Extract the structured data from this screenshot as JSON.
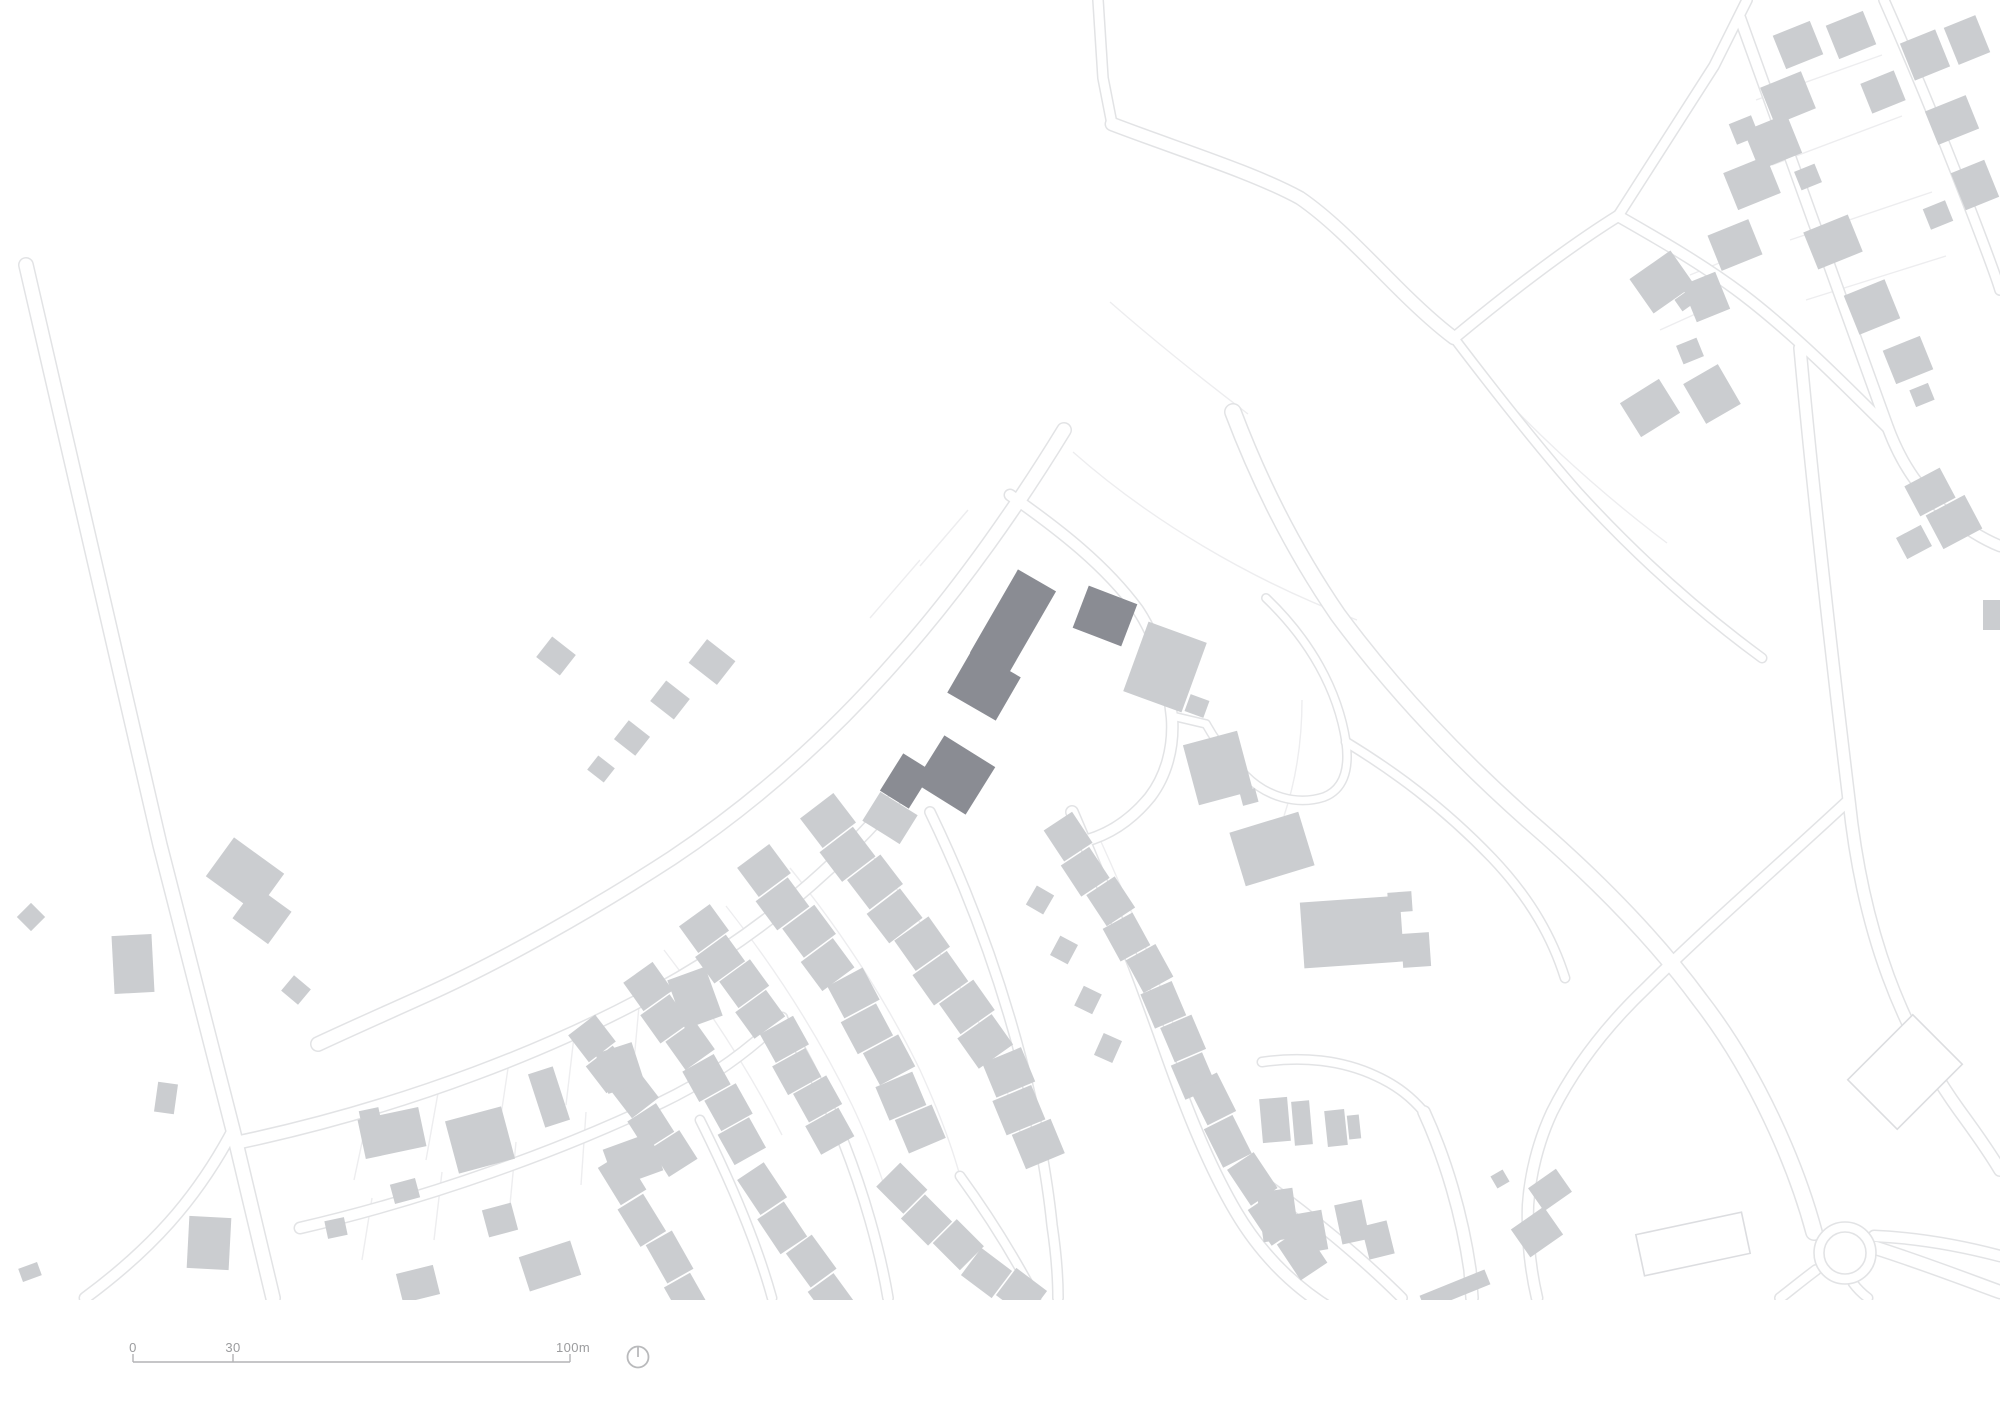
{
  "colors": {
    "background": "#ffffff",
    "building_light": "#cbcdd0",
    "building_site": "#8a8c93",
    "building_outline_stroke": "#dcdde0",
    "road_casing": "#e2e3e5",
    "parcel_line": "#ededef",
    "scalebar_line": "#b3b4b6",
    "scalebar_text": "#9b9c9e",
    "north_icon": "#b9babc"
  },
  "scalebar": {
    "x1": 133,
    "x2": 570,
    "y": 1362,
    "label_y": 1340,
    "tick_xs": [
      133,
      233,
      570
    ],
    "labels": [
      {
        "text": "0",
        "x": 133
      },
      {
        "text": "30",
        "x": 233
      },
      {
        "text": "100m",
        "x": 573
      }
    ]
  },
  "north_icon": {
    "cx": 638,
    "cy": 1357,
    "r": 10.5
  },
  "map": {
    "width": 2000,
    "height": 1414,
    "content_bottom": 1300,
    "roads": [
      {
        "d": "M 26 265 L 160 845 L 233 1130 L 273 1298",
        "w": 13
      },
      {
        "d": "M 233 1130 C 196 1200 150 1250 85 1298",
        "w": 10
      },
      {
        "d": "M 240 1142 C 400 1108 560 1048 680 978 C 762 930 834 870 894 800",
        "w": 12
      },
      {
        "d": "M 300 1228 C 430 1198 562 1150 662 1102 C 712 1078 752 1048 782 1018",
        "w": 10
      },
      {
        "d": "M 1098 0 L 1103 78 L 1112 124",
        "w": 9
      },
      {
        "d": "M 1112 124 C 1180 150 1252 172 1300 198 C 1332 220 1362 252 1396 286 C 1420 310 1438 326 1454 338",
        "w": 12
      },
      {
        "d": "M 1454 338 C 1492 388 1534 442 1578 492 C 1640 560 1702 614 1762 658",
        "w": 8
      },
      {
        "d": "M 1454 338 C 1512 290 1570 246 1618 216",
        "w": 10
      },
      {
        "d": "M 1618 216 L 1714 66 L 1747 0",
        "w": 9
      },
      {
        "d": "M 1740 18 C 1790 160 1840 296 1888 428 C 1903 468 1922 492 1945 512 C 1965 528 1985 540 2000 546",
        "w": 10
      },
      {
        "d": "M 1884 0 C 1915 70 1946 146 1973 216 C 1986 250 1996 276 2000 290",
        "w": 9
      },
      {
        "d": "M 1618 216 C 1660 240 1702 264 1742 294 C 1792 332 1842 382 1888 428",
        "w": 10
      },
      {
        "d": "M 1800 348 C 1812 480 1832 660 1849 800 C 1863 935 1903 1032 1959 1110 C 1981 1140 1994 1160 2000 1170",
        "w": 11
      },
      {
        "d": "M 1064 430 C 1020 502 962 586 898 658 C 830 736 756 802 672 858 C 592 910 500 962 424 996 C 384 1014 348 1030 318 1044",
        "w": 13
      },
      {
        "d": "M 1010 495 C 1060 530 1106 566 1138 610 C 1158 640 1168 680 1172 718 C 1174 748 1166 776 1150 797 C 1128 824 1102 838 1076 843",
        "w": 10
      },
      {
        "d": "M 1072 812 C 1108 896 1140 978 1166 1052 C 1188 1114 1210 1168 1236 1212 C 1262 1256 1296 1288 1332 1310",
        "w": 11
      },
      {
        "d": "M 930 812 C 975 905 1008 1000 1030 1095 C 1040 1140 1048 1185 1052 1225 C 1056 1252 1058 1276 1058 1298",
        "w": 9
      },
      {
        "d": "M 782 1018 C 820 1080 850 1150 870 1220 C 878 1248 884 1274 888 1298",
        "w": 9
      },
      {
        "d": "M 700 1120 C 730 1180 756 1240 772 1298",
        "w": 8
      },
      {
        "d": "M 960 1176 C 992 1220 1016 1260 1036 1298",
        "w": 8
      },
      {
        "d": "M 1233 412 C 1258 478 1292 548 1338 615 C 1392 688 1456 756 1528 820 C 1600 882 1656 940 1700 1000 C 1756 1072 1796 1165 1814 1232",
        "w": 15
      },
      {
        "d": "M 1849 800 C 1776 868 1706 928 1646 988 C 1602 1030 1572 1072 1552 1112 C 1538 1142 1530 1175 1528 1205 C 1527 1236 1530 1268 1537 1298",
        "w": 10
      },
      {
        "d": "M 1266 598 C 1310 640 1338 690 1346 742 C 1350 772 1342 790 1324 797 C 1296 806 1266 796 1246 776 C 1230 760 1216 742 1206 724",
        "w": 7
      },
      {
        "d": "M 1172 716 L 1206 724",
        "w": 7
      },
      {
        "d": "M 1346 742 C 1392 770 1442 806 1492 858 C 1532 900 1553 940 1565 978",
        "w": 8
      },
      {
        "d": "M 1262 1062 C 1302 1056 1342 1060 1376 1076 C 1398 1086 1412 1098 1424 1112",
        "w": 8
      },
      {
        "d": "M 1424 1112 C 1446 1160 1462 1215 1470 1270 L 1472 1298",
        "w": 11
      },
      {
        "d": "M 1258 1178 C 1310 1215 1362 1258 1402 1298",
        "w": 9
      },
      {
        "d": "M 1876 1248 C 1920 1262 1962 1278 2000 1292",
        "w": 12
      },
      {
        "d": "M 1874 1236 C 1920 1238 1962 1246 2000 1256",
        "w": 10
      },
      {
        "d": "M 1816 1270 C 1800 1282 1788 1292 1780 1298",
        "w": 9
      },
      {
        "d": "M 1853 1283 C 1858 1290 1864 1295 1868 1298",
        "w": 8
      }
    ],
    "parcel_lines": [
      {
        "d": "M 1073 452 C 1150 520 1250 580 1357 620"
      },
      {
        "d": "M 1460 349 C 1520 420 1594 488 1667 543"
      },
      {
        "d": "M 1110 302 C 1158 344 1206 382 1248 414"
      },
      {
        "d": "M 920 560 L 870 618"
      },
      {
        "d": "M 968 510 L 920 566"
      },
      {
        "d": "M 852 830 C 900 890 945 955 980 1025 C 1000 1068 1016 1115 1028 1160"
      },
      {
        "d": "M 790 868 C 840 930 885 998 920 1070 C 936 1105 950 1140 960 1176"
      },
      {
        "d": "M 726 906 C 775 968 818 1035 852 1105 C 864 1130 875 1158 884 1185"
      },
      {
        "d": "M 664 950 C 710 1010 750 1072 782 1135"
      },
      {
        "d": "M 1098 835 C 1130 905 1158 975 1180 1045"
      },
      {
        "d": "M 370 1105 L 354 1180"
      },
      {
        "d": "M 440 1082 L 426 1160"
      },
      {
        "d": "M 510 1055 L 498 1135"
      },
      {
        "d": "M 575 1028 L 566 1105"
      },
      {
        "d": "M 640 995 L 633 1072"
      },
      {
        "d": "M 372 1198 L 362 1260"
      },
      {
        "d": "M 442 1172 L 434 1240"
      },
      {
        "d": "M 516 1142 L 509 1215"
      },
      {
        "d": "M 586 1112 L 581 1185"
      },
      {
        "d": "M 1756 100 L 1882 55"
      },
      {
        "d": "M 1772 165 L 1902 116"
      },
      {
        "d": "M 1790 240 L 1932 192"
      },
      {
        "d": "M 1806 300 L 1946 256"
      },
      {
        "d": "M 1690 275 L 1746 252"
      },
      {
        "d": "M 1660 330 L 1722 302"
      },
      {
        "d": "M 1302 700 C 1302 740 1296 780 1284 816"
      }
    ],
    "roundabout": {
      "cx": 1845,
      "cy": 1253,
      "r_outer": 31,
      "r_inner": 21
    },
    "terrace_rows": [
      {
        "pts": [
          [
            826,
            822
          ],
          [
            920,
            945
          ],
          [
            1000,
            1058
          ],
          [
            1036,
            1145
          ]
        ],
        "n": 11,
        "h": 42
      },
      {
        "pts": [
          [
            762,
            872
          ],
          [
            848,
            988
          ],
          [
            896,
            1078
          ],
          [
            918,
            1130
          ]
        ],
        "n": 9,
        "h": 40
      },
      {
        "pts": [
          [
            702,
            930
          ],
          [
            782,
            1040
          ],
          [
            832,
            1130
          ]
        ],
        "n": 8,
        "h": 38
      },
      {
        "pts": [
          [
            646,
            988
          ],
          [
            706,
            1072
          ],
          [
            744,
            1140
          ]
        ],
        "n": 6,
        "h": 36
      },
      {
        "pts": [
          [
            590,
            1040
          ],
          [
            640,
            1105
          ],
          [
            672,
            1155
          ]
        ],
        "n": 5,
        "h": 34
      },
      {
        "pts": [
          [
            1066,
            838
          ],
          [
            1120,
            920
          ],
          [
            1164,
            1000
          ],
          [
            1196,
            1075
          ]
        ],
        "n": 8,
        "h": 34
      },
      {
        "pts": [
          [
            1210,
            1100
          ],
          [
            1250,
            1180
          ],
          [
            1300,
            1255
          ]
        ],
        "n": 5,
        "h": 32
      },
      {
        "pts": [
          [
            900,
            1190
          ],
          [
            960,
            1250
          ],
          [
            1020,
            1295
          ]
        ],
        "n": 5,
        "h": 34
      },
      {
        "pts": [
          [
            760,
            1190
          ],
          [
            800,
            1250
          ],
          [
            835,
            1298
          ]
        ],
        "n": 4,
        "h": 32
      },
      {
        "pts": [
          [
            620,
            1180
          ],
          [
            660,
            1245
          ],
          [
            690,
            1298
          ]
        ],
        "n": 4,
        "h": 30
      }
    ],
    "buildings": [
      [
        1013,
        622,
        44,
        96,
        30,
        1
      ],
      [
        1105,
        616,
        52,
        45,
        21,
        1
      ],
      [
        984,
        685,
        56,
        50,
        30,
        1
      ],
      [
        955,
        775,
        60,
        56,
        32,
        1
      ],
      [
        906,
        781,
        34,
        44,
        32,
        1
      ],
      [
        1905,
        1072,
        70,
        92,
        45,
        2
      ],
      [
        1693,
        1244,
        108,
        42,
        -12,
        2
      ],
      [
        712,
        662,
        36,
        30,
        38,
        0
      ],
      [
        670,
        700,
        30,
        26,
        38,
        0
      ],
      [
        632,
        738,
        27,
        24,
        38,
        0
      ],
      [
        601,
        769,
        21,
        18,
        38,
        0
      ],
      [
        556,
        656,
        30,
        26,
        38,
        0
      ],
      [
        890,
        818,
        44,
        34,
        32,
        0
      ],
      [
        1165,
        667,
        62,
        74,
        20,
        0
      ],
      [
        1197,
        706,
        20,
        18,
        20,
        0
      ],
      [
        1218,
        768,
        56,
        62,
        -15,
        0
      ],
      [
        1249,
        797,
        16,
        14,
        -15,
        0
      ],
      [
        1272,
        849,
        72,
        56,
        -17,
        0
      ],
      [
        1352,
        932,
        100,
        66,
        -4,
        0
      ],
      [
        1400,
        902,
        24,
        20,
        -4,
        0
      ],
      [
        1416,
        950,
        28,
        34,
        -4,
        0
      ],
      [
        1662,
        282,
        50,
        42,
        -35,
        0
      ],
      [
        1685,
        301,
        16,
        14,
        -35,
        0
      ],
      [
        1650,
        408,
        46,
        40,
        -32,
        0
      ],
      [
        1712,
        394,
        40,
        46,
        -30,
        0
      ],
      [
        1930,
        492,
        40,
        34,
        -28,
        0
      ],
      [
        1954,
        522,
        44,
        38,
        -28,
        0
      ],
      [
        1914,
        542,
        28,
        24,
        -28,
        0
      ],
      [
        31,
        917,
        20,
        20,
        45,
        0
      ],
      [
        133,
        964,
        40,
        58,
        -3,
        0
      ],
      [
        245,
        875,
        62,
        48,
        36,
        0
      ],
      [
        262,
        915,
        44,
        40,
        36,
        0
      ],
      [
        296,
        990,
        22,
        20,
        40,
        0
      ],
      [
        166,
        1098,
        20,
        30,
        8,
        0
      ],
      [
        209,
        1243,
        42,
        52,
        3,
        0
      ],
      [
        30,
        1272,
        20,
        14,
        -20,
        0
      ],
      [
        392,
        1133,
        62,
        40,
        -12,
        0
      ],
      [
        370,
        1116,
        20,
        14,
        -12,
        0
      ],
      [
        480,
        1140,
        58,
        54,
        -15,
        0
      ],
      [
        549,
        1097,
        26,
        56,
        -18,
        0
      ],
      [
        620,
        1068,
        38,
        42,
        -18,
        0
      ],
      [
        695,
        998,
        40,
        52,
        -20,
        0
      ],
      [
        633,
        1160,
        50,
        40,
        -20,
        0
      ],
      [
        405,
        1191,
        26,
        20,
        -15,
        0
      ],
      [
        500,
        1220,
        30,
        28,
        -15,
        0
      ],
      [
        550,
        1266,
        54,
        36,
        -18,
        0
      ],
      [
        418,
        1284,
        38,
        30,
        -14,
        0
      ],
      [
        336,
        1228,
        20,
        18,
        -12,
        0
      ],
      [
        345,
        1316,
        26,
        20,
        -12,
        0
      ],
      [
        1040,
        900,
        20,
        22,
        30,
        0
      ],
      [
        1064,
        950,
        20,
        22,
        28,
        0
      ],
      [
        1088,
        1000,
        20,
        22,
        26,
        0
      ],
      [
        1108,
        1048,
        20,
        24,
        24,
        0
      ],
      [
        1275,
        1120,
        28,
        44,
        -5,
        0
      ],
      [
        1302,
        1123,
        18,
        44,
        -5,
        0
      ],
      [
        1336,
        1128,
        20,
        36,
        -6,
        0
      ],
      [
        1354,
        1127,
        12,
        24,
        -6,
        0
      ],
      [
        1278,
        1215,
        36,
        50,
        -8,
        0
      ],
      [
        1310,
        1232,
        30,
        40,
        -10,
        0
      ],
      [
        1352,
        1222,
        28,
        40,
        -12,
        0
      ],
      [
        1378,
        1240,
        26,
        34,
        -14,
        0
      ],
      [
        1500,
        1179,
        14,
        14,
        -30,
        0
      ],
      [
        1550,
        1190,
        34,
        28,
        -35,
        0
      ],
      [
        1537,
        1232,
        40,
        34,
        -35,
        0
      ],
      [
        1455,
        1290,
        70,
        16,
        -22,
        0
      ],
      [
        1798,
        45,
        40,
        36,
        -22,
        0
      ],
      [
        1788,
        98,
        44,
        40,
        -22,
        0
      ],
      [
        1773,
        142,
        46,
        42,
        -22,
        0
      ],
      [
        1744,
        130,
        24,
        22,
        -22,
        0
      ],
      [
        1808,
        177,
        22,
        20,
        -22,
        0
      ],
      [
        1752,
        183,
        46,
        40,
        -22,
        0
      ],
      [
        1735,
        245,
        44,
        38,
        -22,
        0
      ],
      [
        1706,
        297,
        36,
        40,
        -22,
        0
      ],
      [
        1690,
        351,
        22,
        20,
        -22,
        0
      ],
      [
        1851,
        35,
        40,
        36,
        -22,
        0
      ],
      [
        1883,
        92,
        36,
        32,
        -22,
        0
      ],
      [
        1925,
        55,
        38,
        40,
        -22,
        0
      ],
      [
        1952,
        120,
        44,
        36,
        -22,
        0
      ],
      [
        1975,
        185,
        36,
        40,
        -22,
        0
      ],
      [
        1938,
        215,
        24,
        22,
        -22,
        0
      ],
      [
        1833,
        242,
        48,
        40,
        -22,
        0
      ],
      [
        1872,
        307,
        44,
        42,
        -22,
        0
      ],
      [
        1908,
        360,
        40,
        36,
        -22,
        0
      ],
      [
        1922,
        395,
        20,
        18,
        -22,
        0
      ],
      [
        1967,
        40,
        34,
        40,
        -22,
        0
      ],
      [
        1992,
        615,
        18,
        30,
        0,
        0
      ]
    ]
  }
}
